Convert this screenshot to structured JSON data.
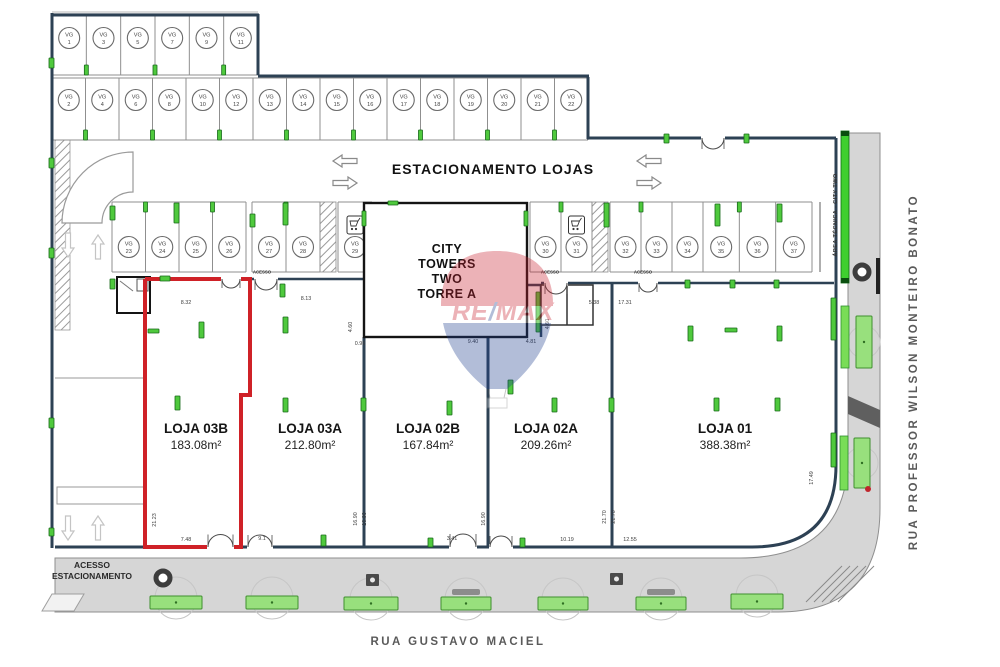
{
  "parking": {
    "prefix": "VG",
    "area_label": "ESTACIONAMENTO LOJAS",
    "acesso_label": "ACESSO",
    "row1": [
      "1",
      "3",
      "5",
      "7",
      "9",
      "11"
    ],
    "row2": [
      "2",
      "4",
      "6",
      "8",
      "10",
      "12",
      "13",
      "14",
      "15",
      "16",
      "17",
      "18",
      "19",
      "20",
      "21",
      "22"
    ],
    "row3_left": [
      "23",
      "24",
      "25",
      "26",
      "27",
      "28",
      "29"
    ],
    "row3_right": [
      "30",
      "31",
      "32",
      "33",
      "34",
      "35",
      "36",
      "37"
    ]
  },
  "tower": {
    "lines": [
      "CITY",
      "TOWERS",
      "TWO",
      "TORRE A"
    ]
  },
  "stores": [
    {
      "name": "LOJA 03B",
      "area": "183.08m²",
      "highlighted": true
    },
    {
      "name": "LOJA 03A",
      "area": "212.80m²",
      "highlighted": false
    },
    {
      "name": "LOJA 02B",
      "area": "167.84m²",
      "highlighted": false
    },
    {
      "name": "LOJA 02A",
      "area": "209.26m²",
      "highlighted": false
    },
    {
      "name": "LOJA 01",
      "area": "388.38m²",
      "highlighted": false
    }
  ],
  "streets": {
    "bottom": "RUA GUSTAVO MACIEL",
    "right": "RUA PROFESSOR WILSON MONTEIRO BONATO"
  },
  "area_tecnica": "ÁREA TÉCNICA - CITY TWO",
  "entrance": {
    "line1": "ACESSO",
    "line2": "ESTACIONAMENTO"
  },
  "watermark": {
    "brand_re": "RE",
    "slash": "/",
    "brand_max": "MAX"
  },
  "dimensions": [
    {
      "v": "8.32",
      "x": 186,
      "y": 304,
      "r": 0
    },
    {
      "v": "8.13",
      "x": 306,
      "y": 300,
      "r": 0
    },
    {
      "v": "5.38",
      "x": 594,
      "y": 304,
      "r": 0
    },
    {
      "v": "17.31",
      "x": 625,
      "y": 304,
      "r": 0
    },
    {
      "v": "4.60",
      "x": 549,
      "y": 324,
      "r": -90
    },
    {
      "v": "4.60",
      "x": 352,
      "y": 327,
      "r": -90
    },
    {
      "v": "0.96",
      "x": 360,
      "y": 345,
      "r": 0
    },
    {
      "v": "9.40",
      "x": 473,
      "y": 343,
      "r": 0
    },
    {
      "v": "4.81",
      "x": 531,
      "y": 343,
      "r": 0
    },
    {
      "v": "21.23",
      "x": 156,
      "y": 520,
      "r": -90
    },
    {
      "v": "7.48",
      "x": 186,
      "y": 541,
      "r": 0
    },
    {
      "v": "9.1",
      "x": 262,
      "y": 540,
      "r": 0
    },
    {
      "v": "16.90",
      "x": 357,
      "y": 519,
      "r": -90
    },
    {
      "v": "16.90",
      "x": 366,
      "y": 519,
      "r": -90
    },
    {
      "v": "16.90",
      "x": 485,
      "y": 519,
      "r": -90
    },
    {
      "v": "3.41",
      "x": 452,
      "y": 540,
      "r": 0
    },
    {
      "v": "10.19",
      "x": 567,
      "y": 541,
      "r": 0
    },
    {
      "v": "21.70",
      "x": 606,
      "y": 517,
      "r": -90
    },
    {
      "v": "21.70",
      "x": 615,
      "y": 517,
      "r": -90
    },
    {
      "v": "12.55",
      "x": 630,
      "y": 541,
      "r": 0
    },
    {
      "v": "17.49",
      "x": 813,
      "y": 478,
      "r": -90
    }
  ],
  "colors": {
    "highlight_red": "#cf2127",
    "wall_blue": "#2d4154",
    "marker_green": "#4fc93d",
    "street_grey": "#d6d6d6"
  }
}
